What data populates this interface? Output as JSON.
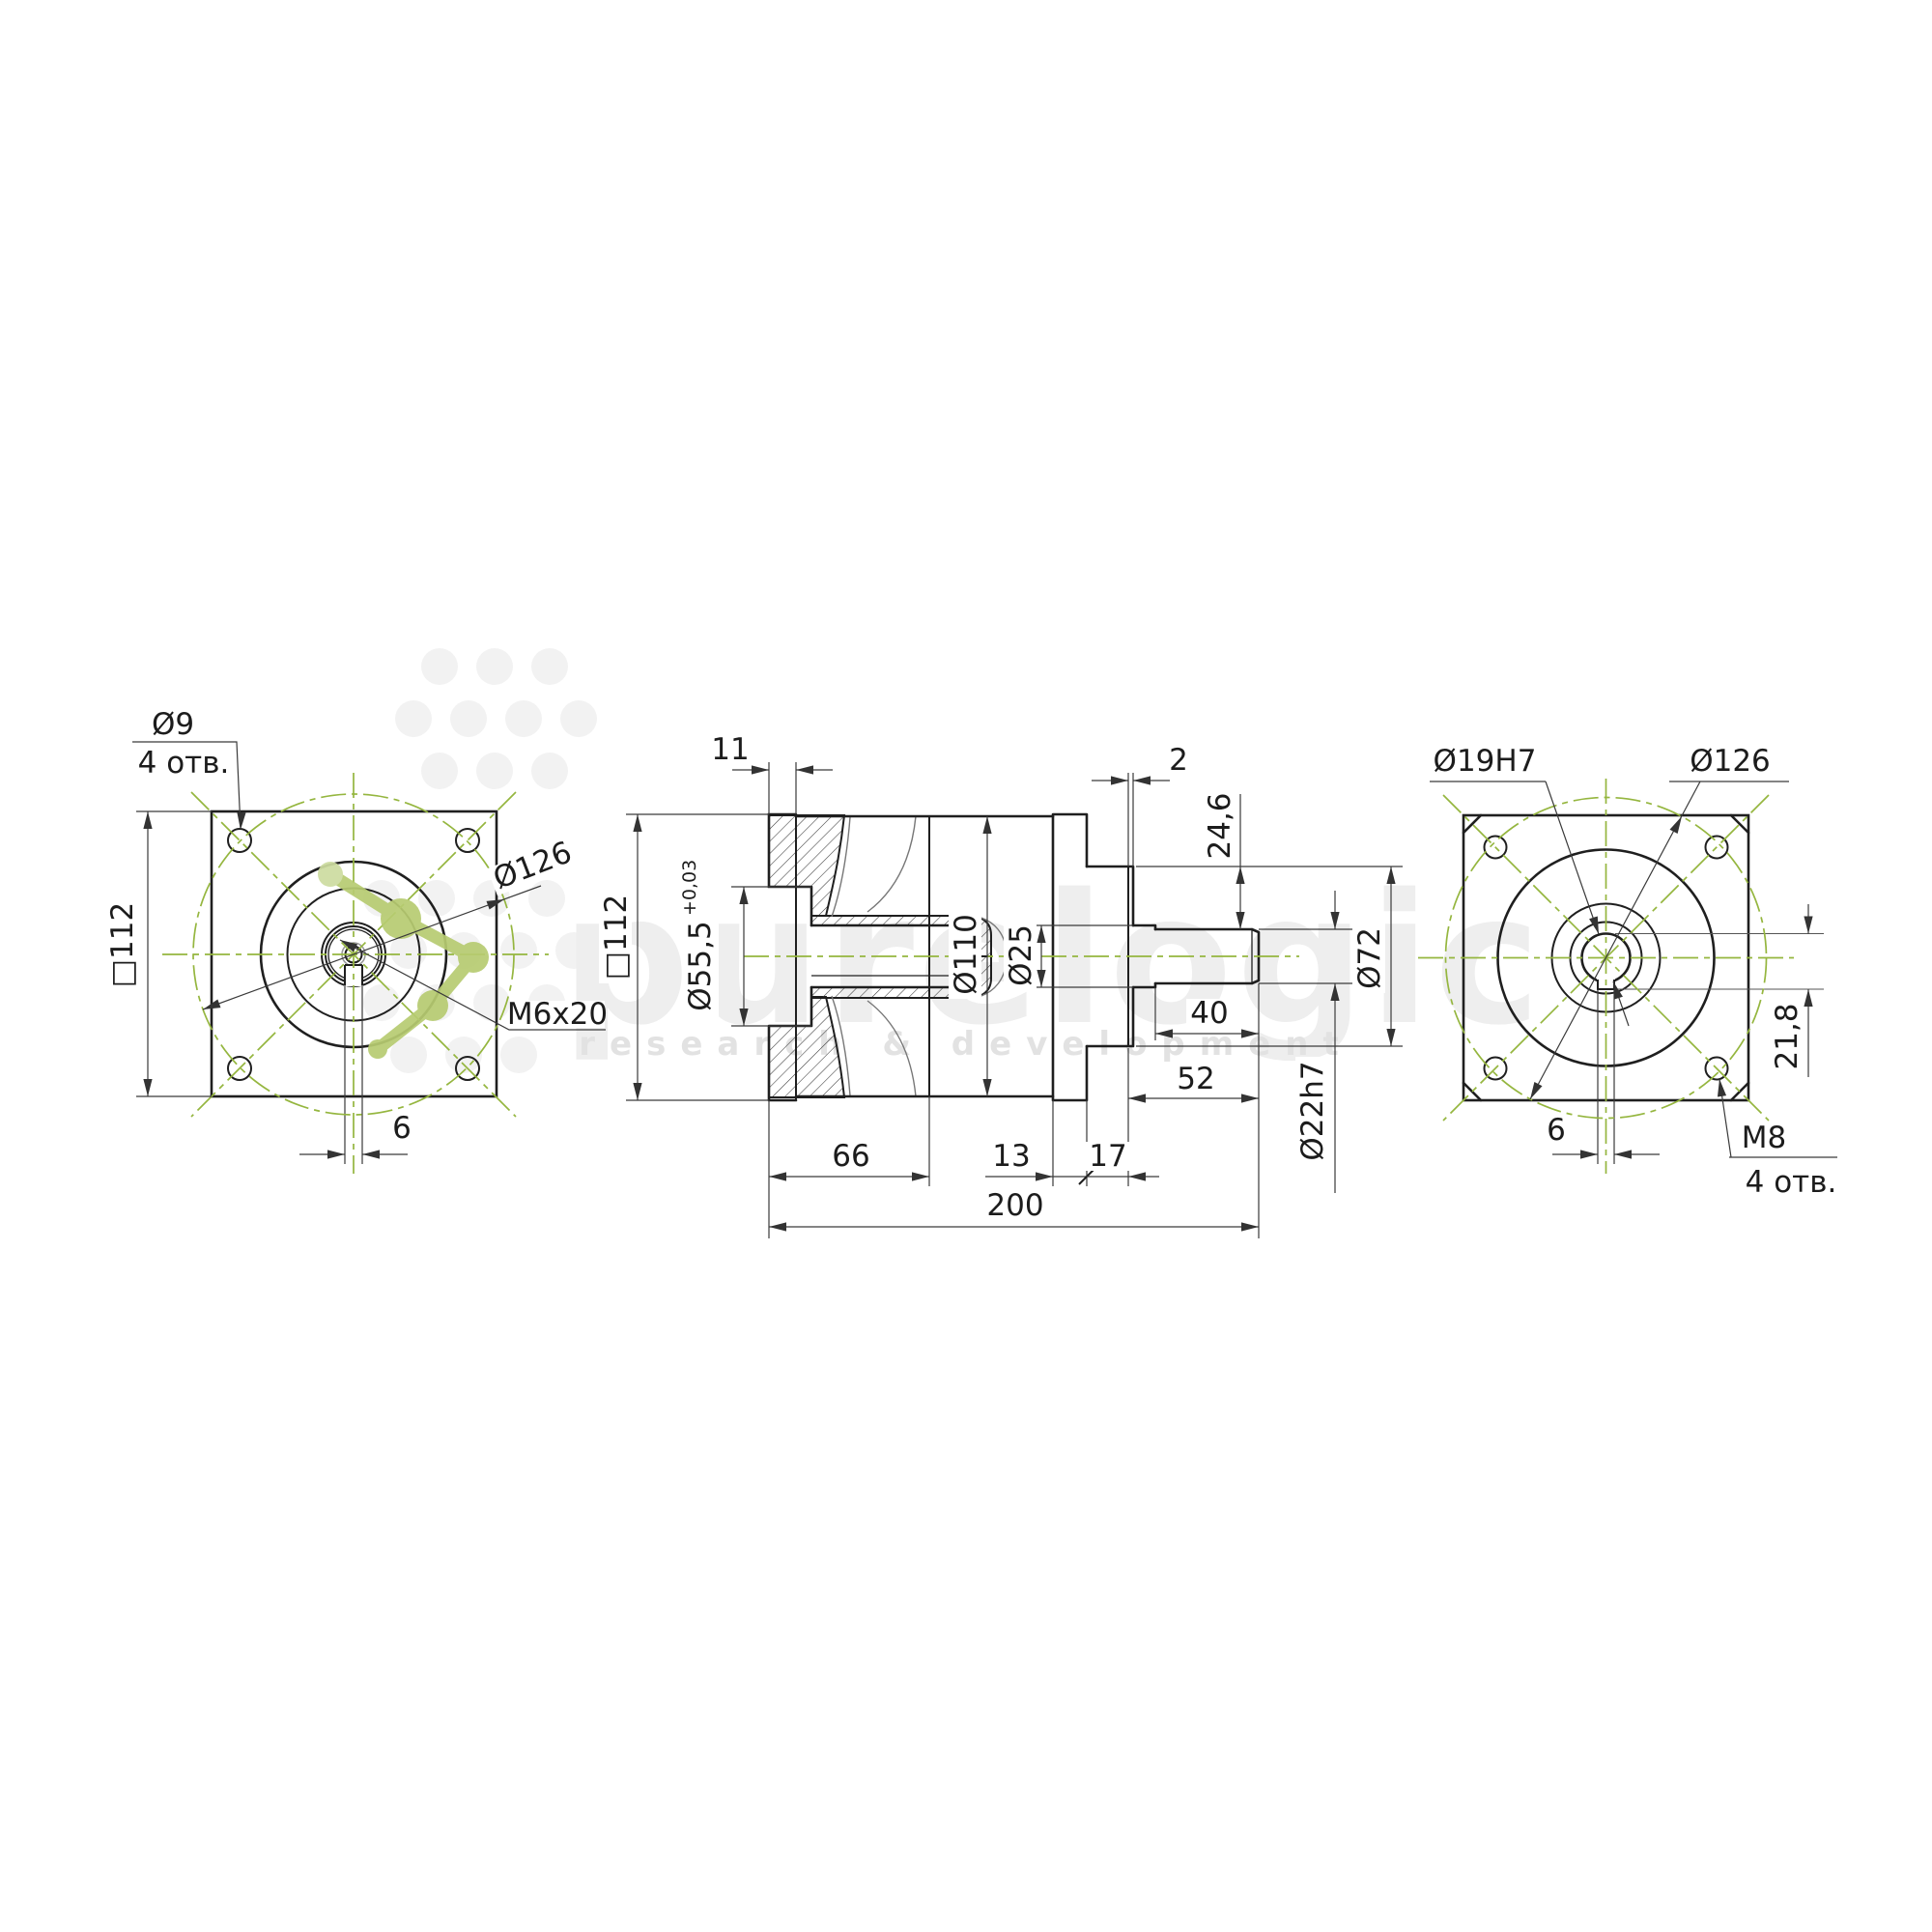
{
  "colors": {
    "line": "#1f1f1f",
    "centerline_green": "#95b63f",
    "molecule_green": "#b7cc71",
    "watermark_gray": "#eeeeee"
  },
  "views": {
    "front": {
      "square": "□112",
      "hole_dia": "Ø9",
      "hole_count": "4 отв.",
      "bolt_circle": "Ø126",
      "thread": "M6x20",
      "key_width": "6"
    },
    "section": {
      "flange_thickness": "11",
      "square": "□112",
      "pilot_dia": "Ø55,5",
      "pilot_tol": "+0,03",
      "body_dia": "Ø110",
      "bore_dia": "Ø25",
      "length_66": "66",
      "length_13": "13",
      "length_17": "17",
      "gap_2": "2",
      "key_height": "24,6",
      "boss_dia": "Ø72",
      "shaft_length": "40",
      "shaft_total": "52",
      "shaft_dia": "Ø22h7",
      "total_length": "200"
    },
    "rear": {
      "bore_dia": "Ø19H7",
      "bolt_circle": "Ø126",
      "keyway_depth": "21,8",
      "key_width": "6",
      "thread": "M8",
      "hole_count": "4 отв."
    }
  },
  "watermark": {
    "brand": "purelogic",
    "tagline": "research & development"
  }
}
